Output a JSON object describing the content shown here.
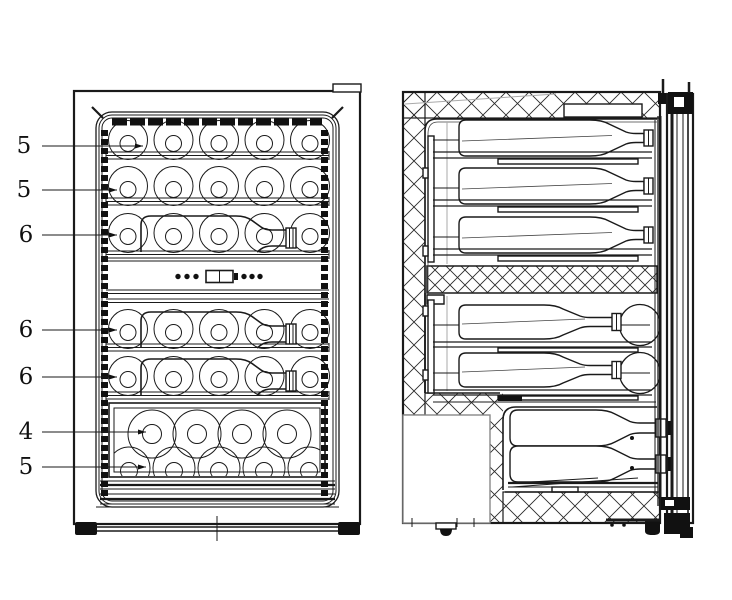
{
  "figure": {
    "labels": [
      {
        "text": "5"
      },
      {
        "text": "5"
      },
      {
        "text": "6"
      },
      {
        "text": "6"
      },
      {
        "text": "6"
      },
      {
        "text": "4"
      },
      {
        "text": "5"
      }
    ],
    "colors": {
      "background": "#ffffff",
      "line": "#1a1a1a"
    }
  }
}
